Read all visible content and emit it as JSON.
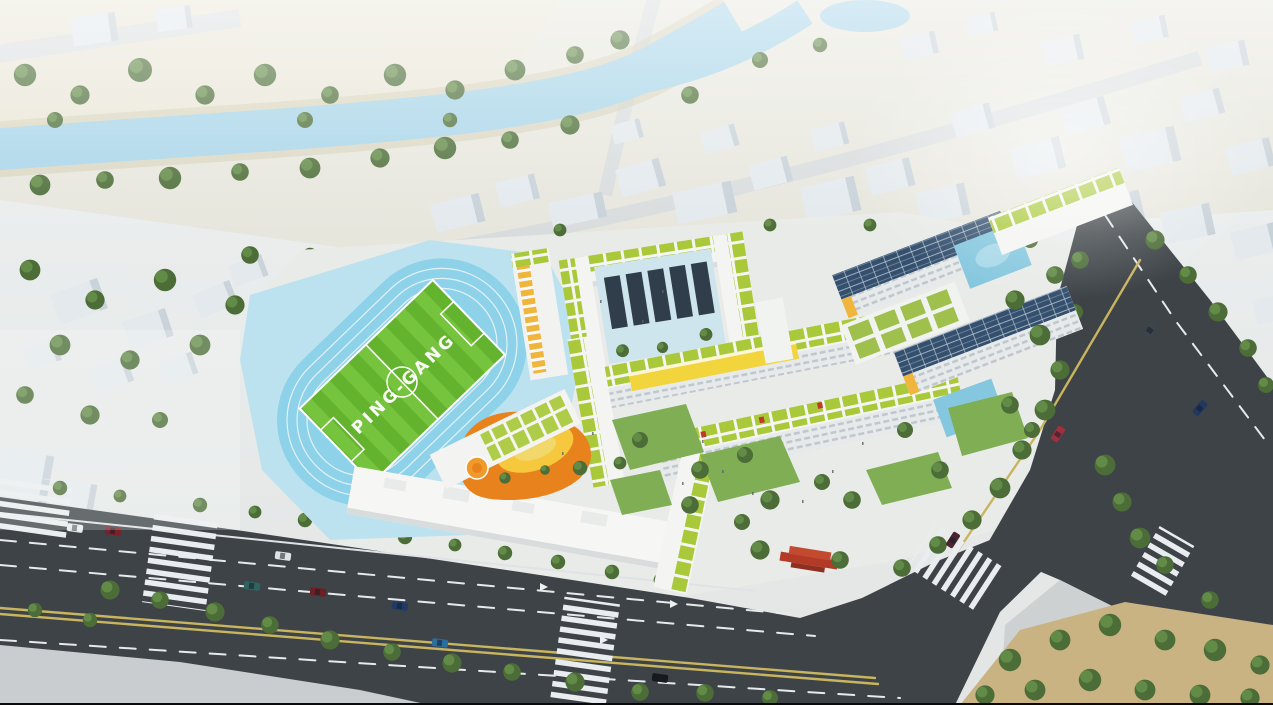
{
  "scene": {
    "type": "aerial-architectural-rendering",
    "title": "Aerial rendering of the Ping-Gang school campus",
    "field_label": "PING-GANG",
    "features": [
      "river and wooded parkland at top",
      "hazy white low-poly context city blocks",
      "running track with blue lanes and striped green soccer field",
      "white school buildings with modular green roofs",
      "buildings with dark solar-panel roofs",
      "yellow connecting sky-bridge",
      "orange kindergarten deck with yellow canopy",
      "red traditional gate pavilion at south entrance",
      "tree-lined boulevard with crosswalks and cars",
      "road intersection and tree park at the south-east"
    ]
  },
  "colors": {
    "river": "#a7d4e8",
    "track": "#8ed2e9",
    "track_apron": "#bce2ef",
    "field_green": "#64b32e",
    "field_stripe": "#76c43e",
    "green_roof": "#a9c93a",
    "lawn": "#7fae54",
    "road": "#3d4347",
    "sidewalk": "#c9cdcf",
    "median_yellow": "#c9b45f",
    "building_white": "#f4f5f2",
    "context_building": "#e3e9ed",
    "solar_panel": "#34506e",
    "accent_orange": "#e8821c",
    "canopy_yellow": "#f6c83e",
    "bridge_yellow": "#f2d53d",
    "balcony_orange": "#f0b53c",
    "red_gate": "#b23a26",
    "park_ground": "#c9b383",
    "court_dark": "#2f3e4a",
    "court_blue": "#85c7de"
  },
  "objects": {
    "cars": [
      {
        "body": "white sedan",
        "color": "#e8eaec"
      },
      {
        "body": "dark-red sedan",
        "color": "#7c2128"
      },
      {
        "body": "teal sedan",
        "color": "#2f6360"
      },
      {
        "body": "maroon sedan",
        "color": "#6e1f26"
      },
      {
        "body": "white sedan",
        "color": "#dfe3e6"
      },
      {
        "body": "dark-blue sedan",
        "color": "#1f3a66"
      },
      {
        "body": "steel-blue sedan",
        "color": "#2b6ea0"
      },
      {
        "body": "black sedan",
        "color": "#16191d"
      },
      {
        "body": "red sedan",
        "color": "#a03040"
      },
      {
        "body": "dark-gray sedan",
        "color": "#3c444c"
      },
      {
        "body": "dark-blue sedan",
        "color": "#233861"
      },
      {
        "body": "dark-purple sedan",
        "color": "#4a2430"
      }
    ]
  }
}
